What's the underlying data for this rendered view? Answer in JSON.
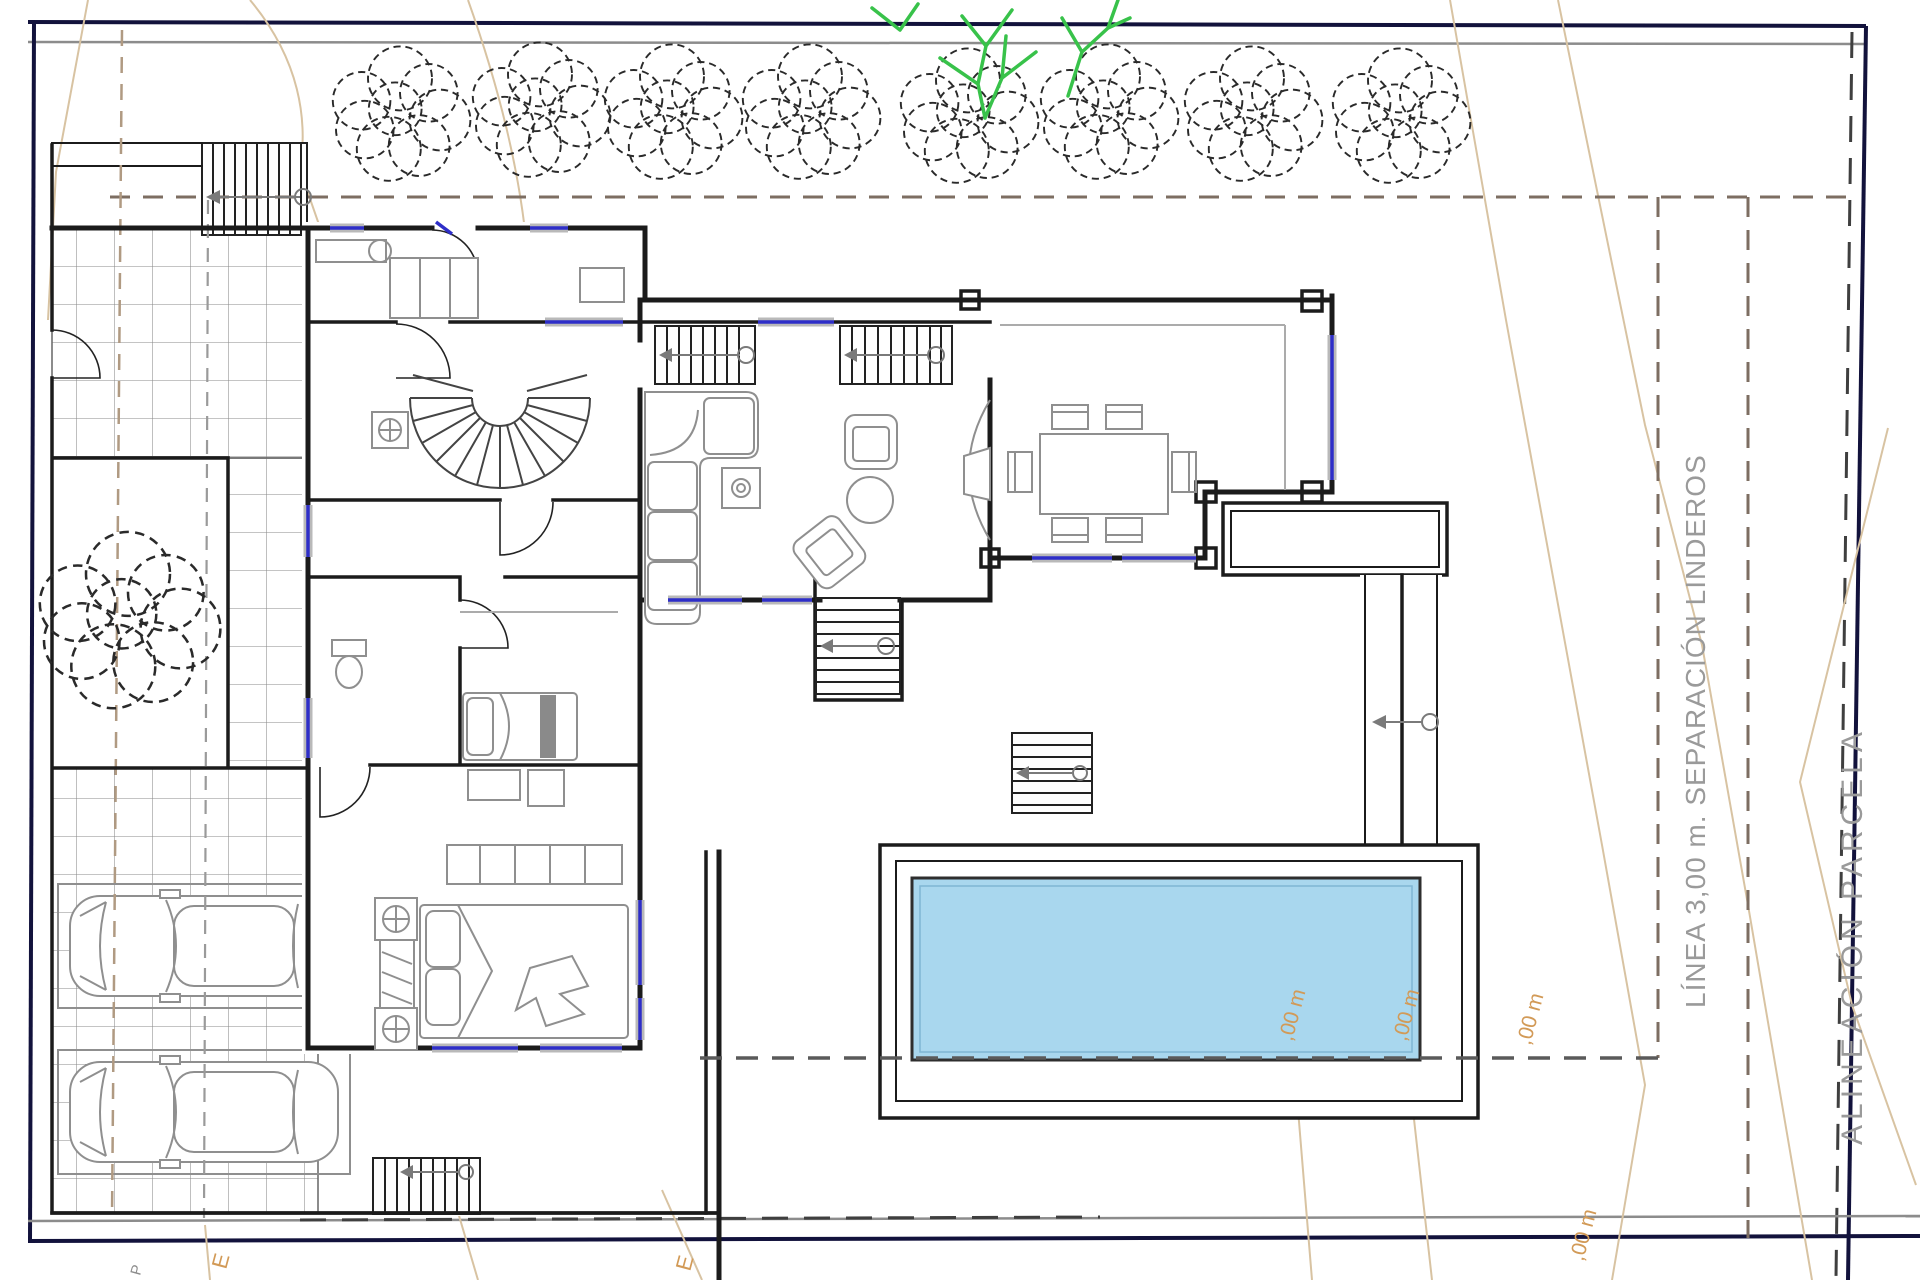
{
  "labels": {
    "separation": "LÍNEA 3,00 m. SEPARACIÓN LINDEROS",
    "alignment": "ALINEACIÓN PARCELA"
  },
  "contour_labels": [
    ",00 m",
    ",00 m",
    ",00 m",
    ",00 m"
  ],
  "markers": [
    "E",
    "E",
    "P"
  ],
  "colors": {
    "wall": "#1b1b1b",
    "boundary": "#12123c",
    "grayline": "#8c8c8c",
    "setback": "#7d6e62",
    "align": "#3f3f3f",
    "contour": "#d8c3a2",
    "label_orange": "#d29a57",
    "label_gray": "#9a9a9a",
    "pool": "#a9d7ee",
    "pool_edge": "#2e2e2e",
    "window": "#2e2ec8",
    "sill": "#b9b9b9",
    "furniture": "#8f8f8f",
    "tree": "#2a2a2a",
    "green": "#38c24a",
    "tile": "#8a8a8a"
  }
}
